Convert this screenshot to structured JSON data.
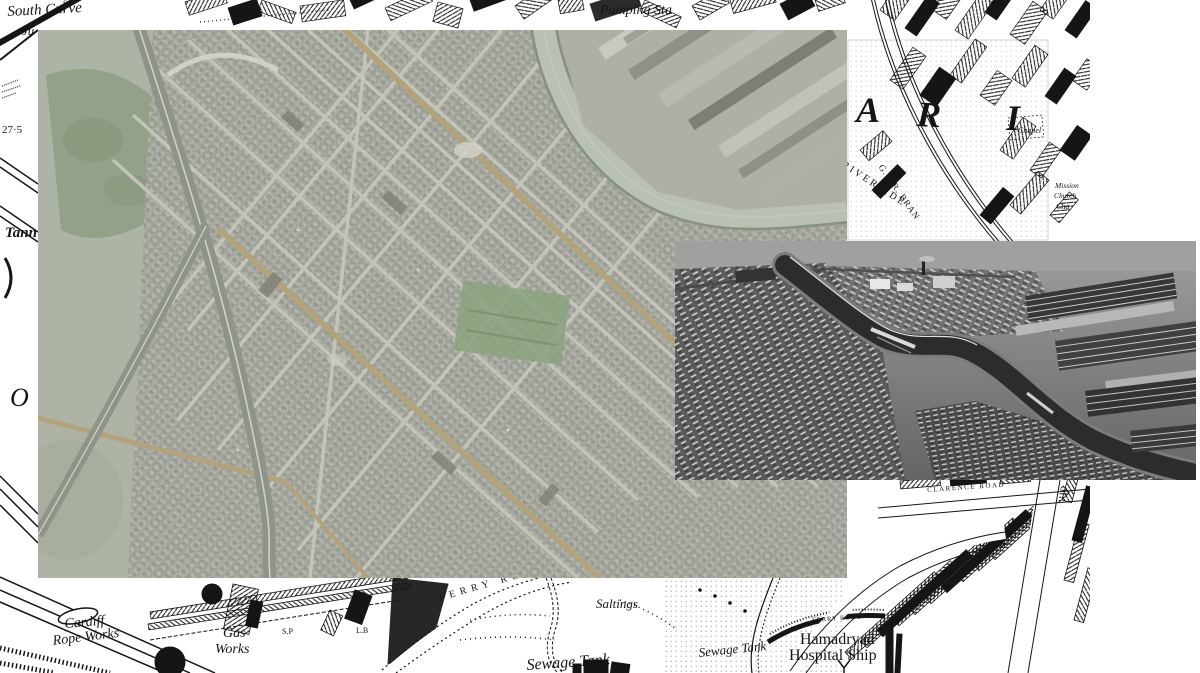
{
  "collage": {
    "base_map_name": "victorian-town-map",
    "vertical_photo_name": "vertical-aerial-photograph",
    "oblique_photo_name": "oblique-aerial-photograph"
  },
  "colors": {
    "canvas_bg": "#ffffff",
    "map_ink": "#151515",
    "map_paper": "#ffffff",
    "photo_vertical_base": "#a6a99f",
    "photo_vertical_fields": "#aeb4a5",
    "photo_vertical_park": "#93a188",
    "photo_vertical_river": "#b9c1b5",
    "photo_vertical_street": "#c7c7be",
    "photo_vertical_road_ochre": "#b3a37d",
    "photo_vertical_rail": "#8f948a",
    "photo_oblique_top": "#a0a09e",
    "photo_oblique_bottom": "#646464",
    "photo_oblique_river": "#2c2c2c"
  },
  "labels": {
    "south_curve": "South Curve",
    "junction": "Ju",
    "sp_top": "S.P",
    "benchmark": "27·5",
    "tannery": "Tann",
    "o_large": "O",
    "pumping_station": "Pumping Sta",
    "letter_a": "A",
    "letter_r": "R",
    "letter_i": "I",
    "riverside": "RIVERSIDE",
    "gwr_branch": "G.W.R. BRAN",
    "chapel": "Chapel",
    "mission": "Mission",
    "church": "Church",
    "chapel_partial": "Cha",
    "clarence_road": "CLARENCE ROAD",
    "ferry_road_small": "FERRY ROAD",
    "hamadryad_line1": "Hamadryad",
    "hamadryad_line2": "Hospital Ship",
    "ferry_road_curved": "FERRY ROAD",
    "saltings": "Saltings",
    "sewage_tank_large": "Sewage Tank",
    "sewage_tank_small": "Sewage Tank",
    "cardiff": "Cardiff",
    "rope_works": "Rope Works",
    "gas": "Gas",
    "works": "Works",
    "sp_bottom": "S.P",
    "lb_bottom": "L.B"
  }
}
